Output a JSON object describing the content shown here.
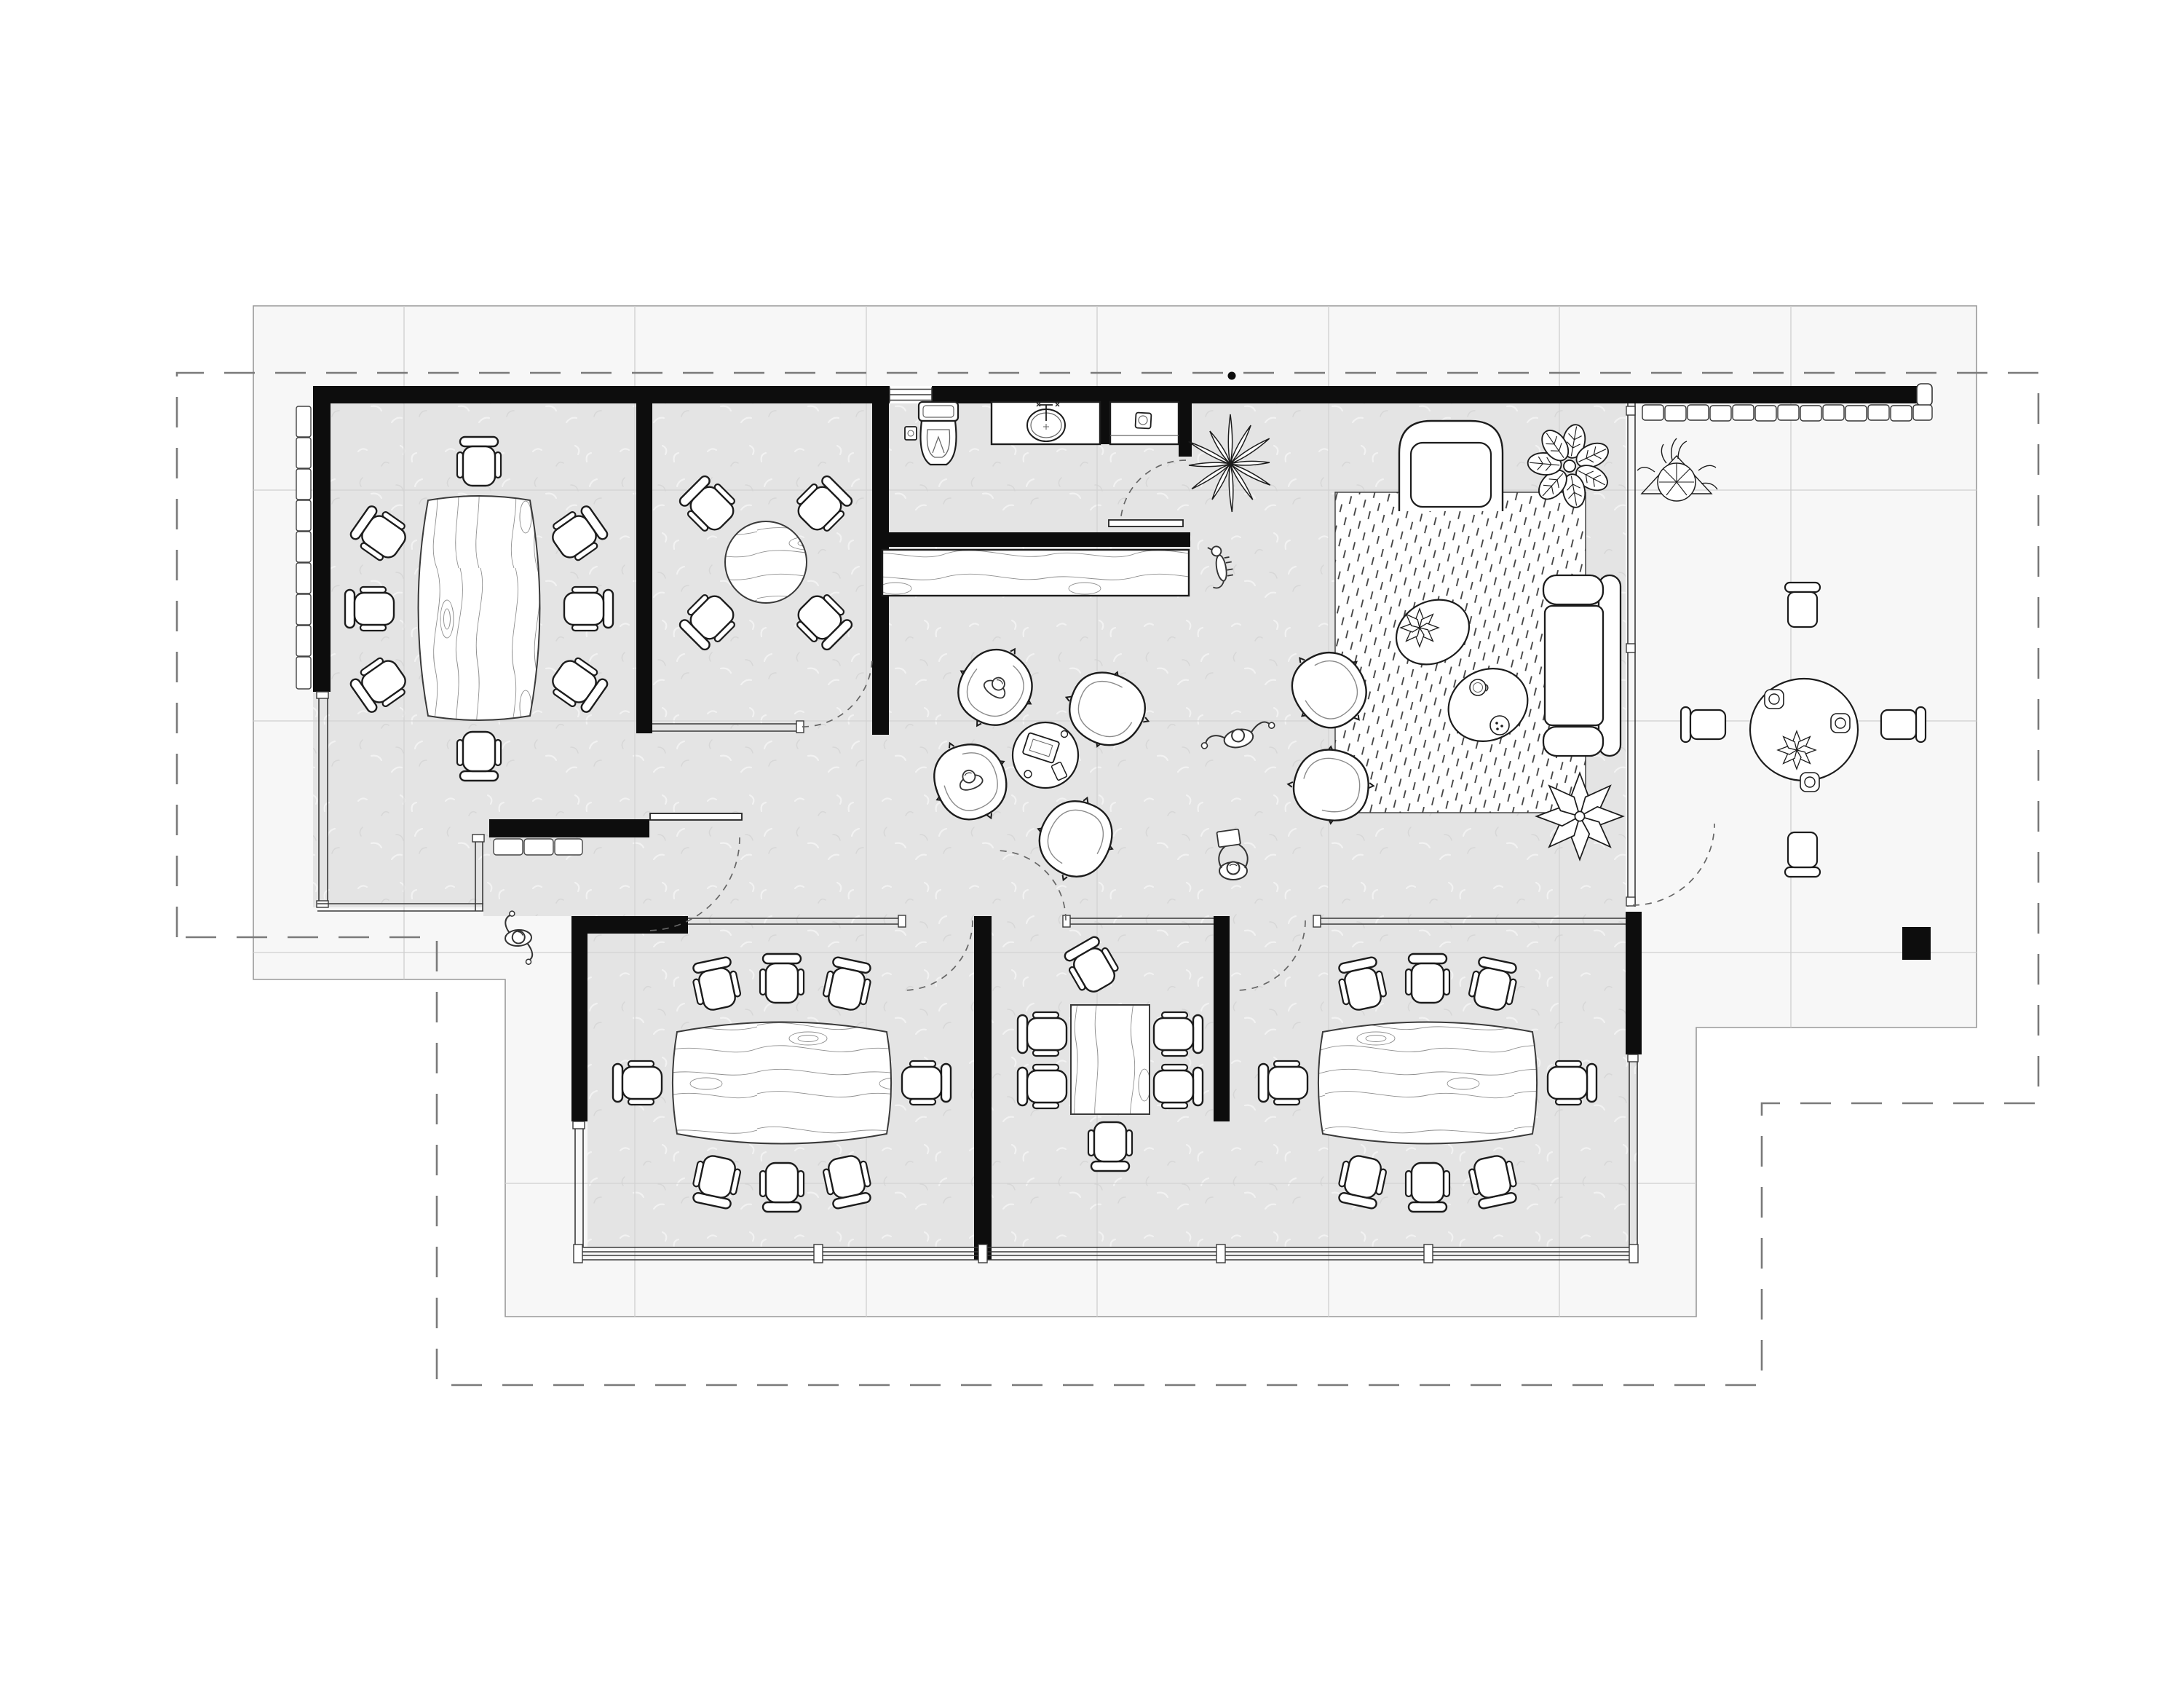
{
  "colors": {
    "paper": "#ffffff",
    "site_tile": "#f7f7f7",
    "site_outline": "#9a9a9a",
    "tile_grid": "#cfcfcf",
    "interior_floor": "#e4e4e4",
    "wall": "#0d0d0d",
    "furniture_line": "#1c1c1c",
    "boundary_dash": "#7a7a7a",
    "wood_grain": "#8f8f8f",
    "rug_hatch": "#3e3e3e"
  },
  "drawing": {
    "type": "architectural-floor-plan-top-view",
    "boundary_style": "dashed-property-line",
    "site": {
      "tile_grid": true,
      "paver_edges": 3,
      "column_marker": 1,
      "wall_dot_marker": 1
    },
    "rooms": [
      {
        "name": "conference-room-west",
        "table": "boat-shaped-wood",
        "chairs": 8
      },
      {
        "name": "huddle-room",
        "table": "round-wood",
        "chairs": 4
      },
      {
        "name": "kitchenette-wc",
        "fixtures": [
          "toilet",
          "basin-counter",
          "sink-counter",
          "window"
        ]
      },
      {
        "name": "hall",
        "items": [
          "wood-credenza",
          "casual-seating-cluster",
          "side-table-with-laptop"
        ],
        "cluster_chairs": 4
      },
      {
        "name": "lounge",
        "items": [
          "area-rug",
          "sofa",
          "armchair",
          "coffee-table-pair",
          "lounge-chairs"
        ],
        "lounge_chairs": 2
      },
      {
        "name": "patio-outdoor",
        "table": "round-dining",
        "chairs": 4,
        "tableware": [
          "cup",
          "cup",
          "cup",
          "flower-centerpiece"
        ]
      },
      {
        "name": "meeting-room-south-west",
        "table": "boat-shaped-wood",
        "chairs": 8
      },
      {
        "name": "meeting-room-south-middle",
        "table": "rect-wood",
        "chairs": 6
      },
      {
        "name": "meeting-room-south-east",
        "table": "boat-shaped-wood",
        "chairs": 8
      }
    ],
    "occupants": {
      "people_standing": 3,
      "people_seated": 2,
      "dogs": 1
    },
    "plants": {
      "spiky": 1,
      "leafy": 1,
      "star": 1,
      "patio_bush": 1
    },
    "door_swings": 7
  }
}
